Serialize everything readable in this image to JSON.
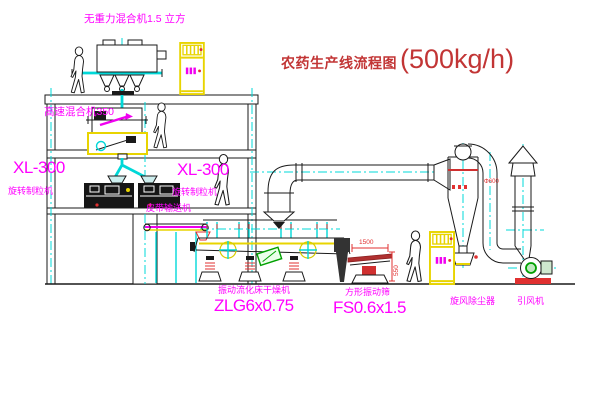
{
  "title": {
    "text_zh": "农药生产线流程图",
    "capacity": "(500kg/h)"
  },
  "labels": {
    "gravity_mixer": "无重力混合机1.5 立方",
    "high_speed_mixer": "高速混合机350",
    "xl300_left": "XL-300",
    "granulator_left": "旋转制粒机",
    "xl300_right": "XL-300",
    "granulator_right": "旋转制粒机",
    "belt_conveyor": "皮带输送机",
    "dryer_name": "振动流化床干燥机",
    "dryer_model": "ZLG6x0.75",
    "sieve_name": "方形振动筛",
    "sieve_model": "FS0.6x1.5",
    "cyclone": "旋风除尘器",
    "fan": "引风机"
  },
  "dimensions": {
    "sieve_length": "1500",
    "sieve_height": "550",
    "pipe_diameter": "Φ600"
  },
  "colors": {
    "label_magenta": "#ff00ff",
    "title_red": "#c23535",
    "centerline_cyan": "#00d8d8",
    "cabinet_yellow": "#e8d400",
    "dimension_red": "#e03030",
    "motor_green": "#00a000"
  }
}
